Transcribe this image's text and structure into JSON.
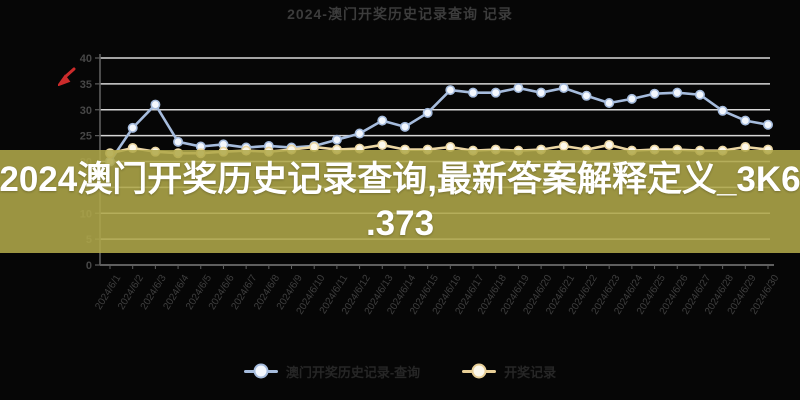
{
  "window": {
    "background": "#060606"
  },
  "header": {
    "title": "2024-澳门开奖历史记录查询 记录"
  },
  "banner": {
    "line1": "2024澳门开奖历史记录查询,最新答案解释定义_3K6",
    "line2": ".373",
    "background": "#9a9340",
    "text_color": "#ffffff"
  },
  "legend": {
    "items": [
      {
        "label": "澳门开奖历史记录-查询",
        "color": "#a6bcdd",
        "fill": "#f3f7fd"
      },
      {
        "label": "开奖记录",
        "color": "#e8cf97",
        "fill": "#fcf8ec"
      }
    ]
  },
  "icons": {
    "red_marker_color": "#cc2b2b"
  },
  "chart_data": {
    "type": "line",
    "title": "2024-澳门开奖历史记录查询 记录",
    "xlabel": "",
    "ylabel": "",
    "ylim": [
      0,
      40
    ],
    "yticks": [
      0,
      5,
      10,
      15,
      20,
      25,
      30,
      35,
      40
    ],
    "grid": true,
    "legend_position": "bottom",
    "grid_color": "#d7d7d7",
    "axis_color": "#5f5f5f",
    "tick_label_color": "#3f3f3f",
    "x": [
      "2024/6/1",
      "2024/6/2",
      "2024/6/3",
      "2024/6/4",
      "2024/6/5",
      "2024/6/6",
      "2024/6/7",
      "2024/6/8",
      "2024/6/9",
      "2024/6/10",
      "2024/6/11",
      "2024/6/12",
      "2024/6/13",
      "2024/6/14",
      "2024/6/15",
      "2024/6/16",
      "2024/6/17",
      "2024/6/18",
      "2024/6/19",
      "2024/6/20",
      "2024/6/21",
      "2024/6/22",
      "2024/6/23",
      "2024/6/24",
      "2024/6/25",
      "2024/6/26",
      "2024/6/27",
      "2024/6/28",
      "2024/6/29",
      "2024/6/30"
    ],
    "series": [
      {
        "name": "澳门开奖历史记录-查询",
        "color": "#a6bcdd",
        "marker_fill": "#f3f7fd",
        "values": [
          20,
          26.5,
          31,
          23.8,
          22.9,
          23.3,
          22.7,
          23,
          22.7,
          23,
          24.2,
          25.4,
          27.9,
          26.7,
          29.4,
          33.8,
          33.3,
          33.3,
          34.2,
          33.3,
          34.2,
          32.7,
          31.3,
          32.1,
          33.1,
          33.3,
          32.9,
          29.8,
          27.9,
          27.1
        ]
      },
      {
        "name": "开奖记录",
        "color": "#ecd7a4",
        "marker_fill": "#fcf8ec",
        "values": [
          21.6,
          22.6,
          21.9,
          21.6,
          21.6,
          21.9,
          22.1,
          21.9,
          22.3,
          22.8,
          22.3,
          22.5,
          23.2,
          22.3,
          22.3,
          22.8,
          22.1,
          22.3,
          22.1,
          22.3,
          23,
          22.3,
          23.2,
          22.1,
          22.3,
          22.3,
          22.1,
          22.1,
          22.8,
          22.3
        ]
      }
    ]
  }
}
